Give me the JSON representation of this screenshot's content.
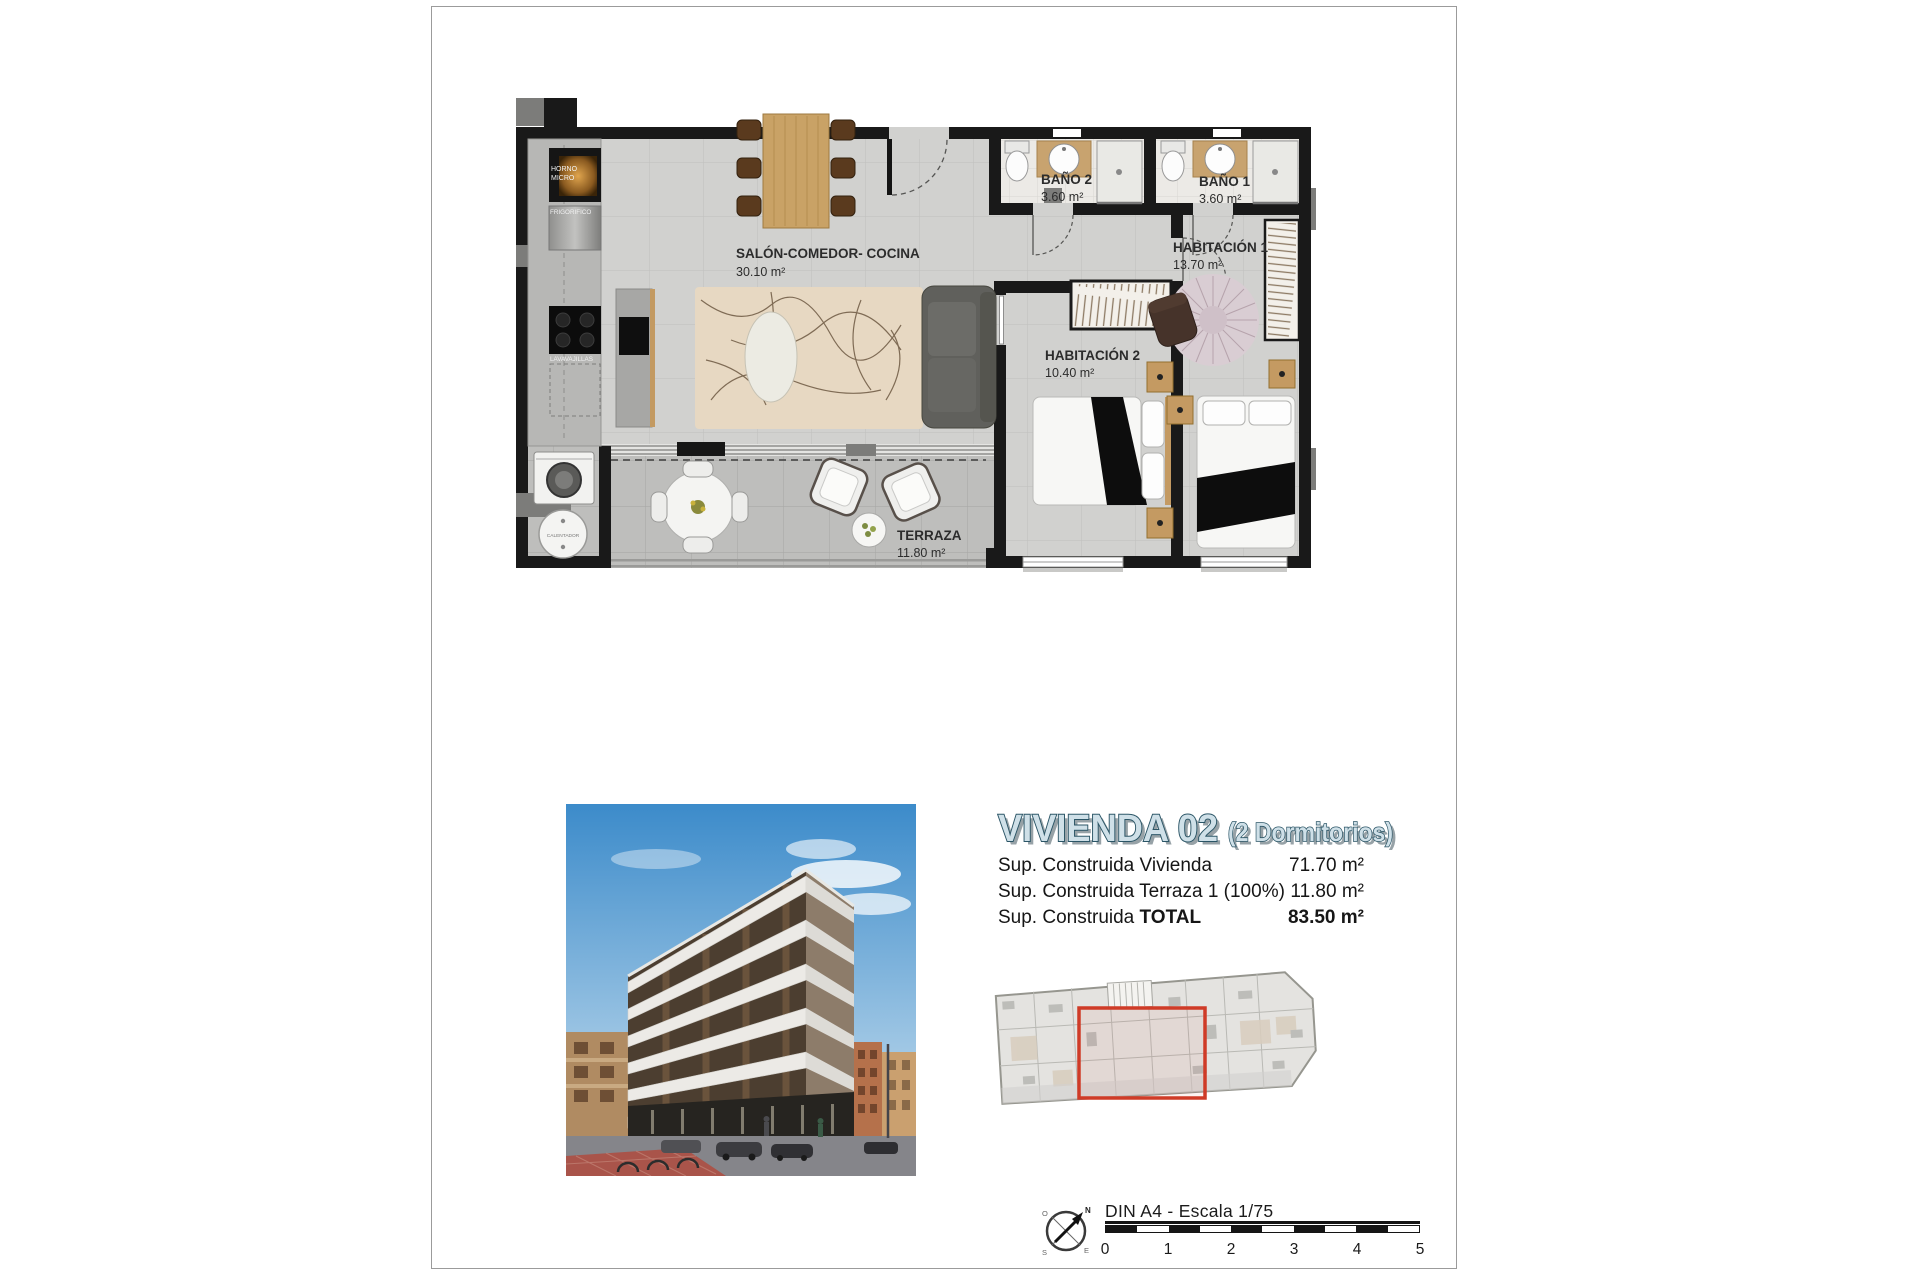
{
  "page": {
    "plan": {
      "rooms": {
        "salon": {
          "name": "SALÓN-COMEDOR- COCINA",
          "area": "30.10 m²"
        },
        "bano2": {
          "name": "BAÑO 2",
          "area": "3.60 m²"
        },
        "bano1": {
          "name": "BAÑO 1",
          "area": "3.60 m²"
        },
        "hab1": {
          "name": "HABITACIÓN 1",
          "area": "13.70 m²"
        },
        "hab2": {
          "name": "HABITACIÓN 2",
          "area": "10.40 m²"
        },
        "terraza": {
          "name": "TERRAZA",
          "area": "11.80 m²"
        }
      },
      "appliances": {
        "horno_l1": "HORNO",
        "horno_l2": "MICRO",
        "frigorifico": "FRIGORIFICO",
        "lavavajillas": "LAVAVAJILLAS",
        "calentador": "CALENTADOR"
      }
    },
    "title": {
      "main": "VIVIENDA 02",
      "sub": "(2 Dormitorios)"
    },
    "surfaces": {
      "rows": [
        {
          "label": "Sup. Construida Vivienda",
          "bold": "",
          "value": "71.70 m²"
        },
        {
          "label": "Sup. Construida Terraza 1 (100%)",
          "bold": "",
          "value": "11.80 m²"
        },
        {
          "label": "Sup. Construida ",
          "bold": "TOTAL",
          "value": "83.50 m²"
        }
      ]
    },
    "footer": {
      "scale_label": "DIN A4 - Escala 1/75",
      "ticks": [
        "0",
        "1",
        "2",
        "3",
        "4",
        "5"
      ],
      "compass": {
        "n": "N",
        "s": "S",
        "e": "E",
        "o": "O"
      }
    },
    "colors": {
      "accent_red": "#cf3b27",
      "title_fill": "#cfe0e8",
      "title_stroke": "#2b5566",
      "wall": "#191919"
    }
  }
}
